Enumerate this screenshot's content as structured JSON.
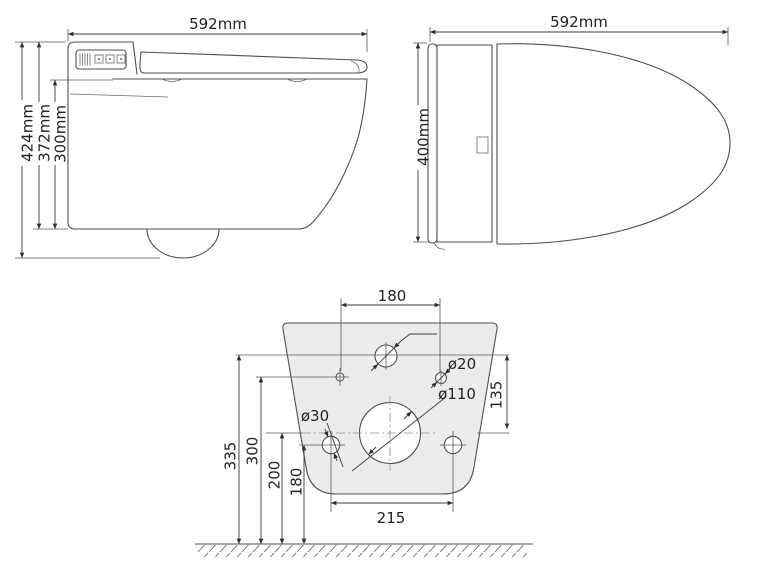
{
  "drawing_title": "wall-hung smart toilet dimensional drawing",
  "side_view": {
    "width_label": "592mm",
    "height_total_label": "424mm",
    "height_body_label": "372mm",
    "height_bowl_label": "300mm"
  },
  "top_view": {
    "width_label": "592mm",
    "depth_label": "400mm"
  },
  "back_view": {
    "top_hole_spacing_label": "180",
    "inlet_hole_diameter_label": "ø20",
    "inlet_drop_label": "135",
    "outlet_diameter_label": "ø110",
    "bolt_hole_diameter_label": "ø30",
    "height_335_label": "335",
    "height_300_label": "300",
    "height_200_label": "200",
    "height_180_label": "180",
    "bolt_spacing_label": "215"
  },
  "colors": {
    "background": "#ffffff",
    "object_line": "#4f4f4f",
    "dimension_line": "#3c3c3c",
    "centerline": "#8c8c8c",
    "plate_fill": "#ebecec",
    "text": "#222222"
  }
}
